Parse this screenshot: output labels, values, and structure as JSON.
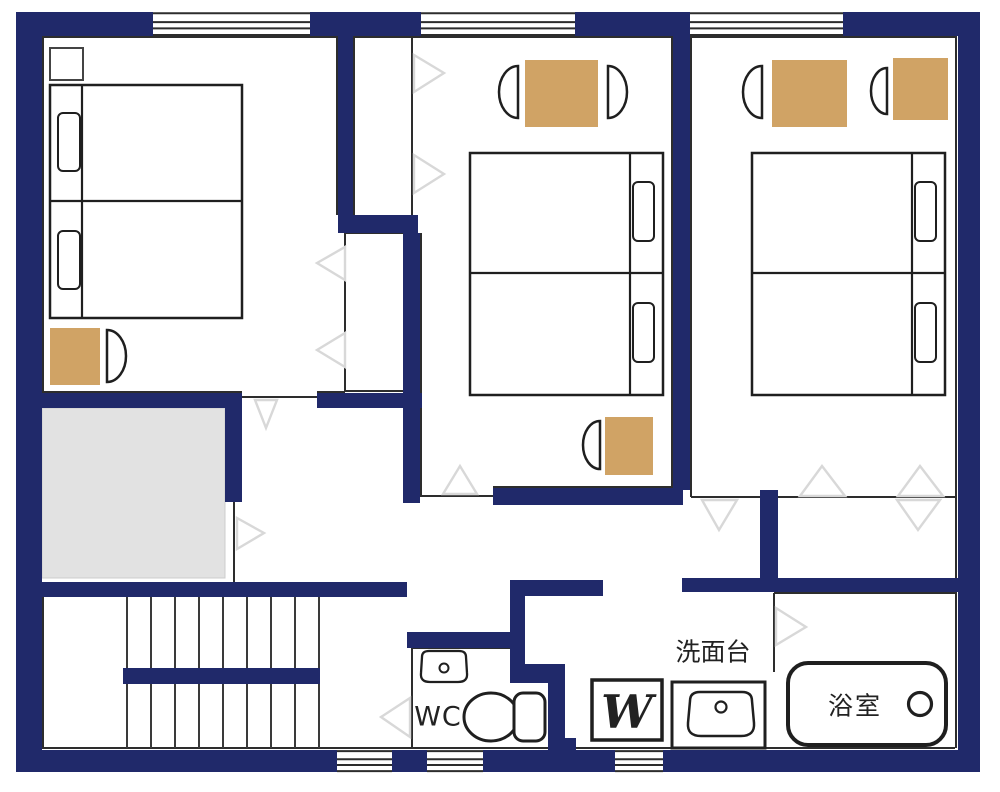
{
  "colors": {
    "wall_navy": "#20296a",
    "mat_tan": "#d0a365",
    "gray_area": "#e2e2e2",
    "gray_area_border": "#cccccc",
    "thin_line": "#2d2d2d",
    "furniture_line": "#1f1f1f",
    "door_marker": "#d8d8d8",
    "floor_white": "#ffffff"
  },
  "labels": {
    "wc": "WC",
    "washstand": "洗面台",
    "bathroom": "浴室",
    "washer": "W"
  },
  "plan": {
    "canvas": [
      1000,
      792
    ],
    "walls": [
      {
        "name": "outer-wall-top",
        "r": [
          16,
          12,
          942,
          24
        ]
      },
      {
        "name": "outer-wall-bottom",
        "r": [
          16,
          750,
          942,
          22
        ]
      },
      {
        "name": "outer-wall-left",
        "r": [
          16,
          12,
          26,
          760
        ]
      },
      {
        "name": "outer-wall-right",
        "r": [
          958,
          12,
          22,
          760
        ]
      },
      {
        "name": "wall-room1-closet-top",
        "r": [
          338,
          36,
          15,
          179
        ]
      },
      {
        "name": "wall-closet-jog",
        "r": [
          338,
          215,
          80,
          18
        ]
      },
      {
        "name": "wall-room2-left",
        "r": [
          403,
          233,
          17,
          270
        ]
      },
      {
        "name": "wall-room1-bottom-right",
        "r": [
          317,
          393,
          105,
          15
        ]
      },
      {
        "name": "wall-room1-bottom-left",
        "r": [
          42,
          393,
          200,
          15
        ]
      },
      {
        "name": "wall-gray-area-right",
        "r": [
          225,
          393,
          17,
          109
        ]
      },
      {
        "name": "wall-above-stairs",
        "r": [
          42,
          582,
          365,
          15
        ]
      },
      {
        "name": "wall-hall-mid",
        "r": [
          510,
          580,
          93,
          16
        ]
      },
      {
        "name": "wall-bath-top",
        "r": [
          682,
          578,
          276,
          14
        ]
      },
      {
        "name": "wall-engawa-divider",
        "r": [
          760,
          490,
          18,
          102
        ]
      },
      {
        "name": "wall-room2-bottom",
        "r": [
          493,
          488,
          190,
          17
        ]
      },
      {
        "name": "wall-room2-room3-divider",
        "r": [
          673,
          36,
          17,
          454
        ]
      },
      {
        "name": "wall-wc-right-upper",
        "r": [
          510,
          596,
          15,
          74
        ]
      },
      {
        "name": "wall-wc-jog",
        "r": [
          510,
          664,
          42,
          19
        ]
      },
      {
        "name": "wall-wc-right-lower",
        "r": [
          548,
          664,
          17,
          86
        ]
      },
      {
        "name": "wall-wc-top",
        "r": [
          407,
          632,
          103,
          16
        ]
      },
      {
        "name": "stair-rail",
        "r": [
          123,
          668,
          197,
          16
        ]
      },
      {
        "name": "wall-wc-foot-block",
        "r": [
          548,
          738,
          28,
          12
        ]
      }
    ],
    "windows": [
      {
        "name": "window-top-1",
        "r": [
          153,
          12,
          157,
          24
        ]
      },
      {
        "name": "window-top-2",
        "r": [
          421,
          12,
          154,
          24
        ]
      },
      {
        "name": "window-top-3",
        "r": [
          690,
          12,
          153,
          24
        ]
      },
      {
        "name": "window-bottom-1",
        "r": [
          337,
          750,
          55,
          22
        ]
      },
      {
        "name": "window-bottom-2",
        "r": [
          427,
          750,
          56,
          22
        ]
      },
      {
        "name": "window-bottom-3",
        "r": [
          615,
          750,
          48,
          22
        ]
      }
    ],
    "lines": [
      [
        42,
        37,
        957,
        37
      ],
      [
        42,
        748,
        955,
        748
      ],
      [
        43,
        37,
        43,
        394
      ],
      [
        43,
        596,
        43,
        748
      ],
      [
        956,
        37,
        956,
        748
      ],
      [
        337,
        37,
        337,
        215
      ],
      [
        354,
        37,
        354,
        215
      ],
      [
        412,
        37,
        412,
        215
      ],
      [
        421,
        233,
        421,
        497
      ],
      [
        345,
        233,
        345,
        391
      ],
      [
        345,
        233,
        403,
        233
      ],
      [
        345,
        391,
        403,
        391
      ],
      [
        42,
        392,
        242,
        392
      ],
      [
        242,
        397,
        317,
        397
      ],
      [
        317,
        392,
        345,
        392
      ],
      [
        672,
        37,
        672,
        488
      ],
      [
        691,
        37,
        691,
        497
      ],
      [
        421,
        496,
        493,
        496
      ],
      [
        493,
        487,
        672,
        487
      ],
      [
        691,
        497,
        955,
        497
      ],
      [
        234,
        502,
        234,
        582
      ],
      [
        774,
        593,
        774,
        672
      ],
      [
        774,
        593,
        955,
        593
      ],
      [
        412,
        647,
        412,
        748
      ],
      [
        412,
        648,
        510,
        648
      ]
    ],
    "gray_area": {
      "name": "stairwell-void",
      "r": [
        42,
        408,
        183,
        170
      ]
    },
    "stairs": {
      "name": "staircase",
      "treads_x": [
        127,
        151,
        175,
        199,
        223,
        247,
        271,
        295,
        319
      ],
      "upper_flight_y": [
        596,
        668
      ],
      "lower_flight_y": [
        684,
        748
      ]
    },
    "mats": [
      {
        "name": "mat-room1",
        "r": [
          50,
          328,
          50,
          57
        ]
      },
      {
        "name": "mat-room2-table",
        "r": [
          525,
          60,
          73,
          67
        ]
      },
      {
        "name": "mat-room2-lower",
        "r": [
          605,
          417,
          48,
          58
        ]
      },
      {
        "name": "mat-room3-table",
        "r": [
          772,
          60,
          75,
          67
        ]
      },
      {
        "name": "mat-room3-side",
        "r": [
          893,
          58,
          55,
          62
        ]
      }
    ],
    "beds": [
      {
        "name": "bed-room1",
        "rect": [
          50,
          85,
          192,
          233
        ],
        "lines": [
          [
            82,
            85,
            82,
            318
          ],
          [
            50,
            201,
            242,
            201
          ]
        ],
        "pillows": [
          [
            58,
            113,
            22,
            58
          ],
          [
            58,
            231,
            22,
            58
          ]
        ]
      },
      {
        "name": "bed-room2",
        "rect": [
          470,
          153,
          193,
          242
        ],
        "lines": [
          [
            630,
            153,
            630,
            395
          ],
          [
            470,
            273,
            663,
            273
          ]
        ],
        "pillows": [
          [
            633,
            182,
            21,
            59
          ],
          [
            633,
            303,
            21,
            59
          ]
        ]
      },
      {
        "name": "bed-room3",
        "rect": [
          752,
          153,
          193,
          242
        ],
        "lines": [
          [
            912,
            153,
            912,
            395
          ],
          [
            752,
            273,
            945,
            273
          ]
        ],
        "pillows": [
          [
            915,
            182,
            21,
            59
          ],
          [
            915,
            303,
            21,
            59
          ]
        ]
      }
    ],
    "nightstand": {
      "name": "nightstand-room1",
      "r": [
        50,
        48,
        33,
        32
      ]
    },
    "chairs": [
      {
        "name": "chair-room1",
        "d": "M107,330 A19,26 0 0 1 107,382 Z"
      },
      {
        "name": "chair-room2-left",
        "d": "M518,66 A19,26 0 0 0 518,118 Z"
      },
      {
        "name": "chair-room2-right",
        "d": "M608,66 A19,26 0 0 1 608,118 Z"
      },
      {
        "name": "chair-room2-lower",
        "d": "M600,421 A17,24 0 0 0 600,469 Z"
      },
      {
        "name": "chair-room3-left",
        "d": "M762,66 A19,26 0 0 0 762,118 Z"
      },
      {
        "name": "chair-room3-side",
        "d": "M887,68 A16,23 0 0 0 887,114 Z"
      }
    ],
    "fixtures": {
      "toilet_bowl": {
        "name": "toilet-bowl-icon",
        "cx": 491,
        "cy": 717,
        "rx": 27,
        "ry": 24
      },
      "toilet_tank": {
        "name": "toilet-tank-icon",
        "r": [
          514,
          693,
          31,
          48
        ],
        "rx": 9
      },
      "wc_sink": {
        "name": "small-sink-icon",
        "d": "M429,651 h30 q7,0 7,6 l1,16 q1,9 -9,9 h-28 q-10,0 -9,-9 l1,-16 q0,-6 7,-6 z",
        "circle": [
          444,
          668,
          4.5
        ]
      },
      "washer_box": {
        "name": "washing-machine-box",
        "r": [
          592,
          680,
          70,
          60
        ]
      },
      "wash_unit_box": {
        "name": "washstand-box",
        "r": [
          672,
          682,
          93,
          66
        ]
      },
      "wash_basin": {
        "name": "washbasin-icon",
        "d": "M700,692 h42 q10,0 10,9 l2,22 q1,13 -13,13 h-40 q-14,0 -13,-13 l2,-22 q0,-9 10,-9 z",
        "circle": [
          721,
          707,
          5.5
        ]
      },
      "bathtub": {
        "name": "bathtub-icon",
        "r": [
          788,
          663,
          158,
          82
        ],
        "rx": 20,
        "drain": [
          920,
          704,
          11.5
        ]
      }
    },
    "triangles": [
      {
        "name": "door-marker-room1-entry",
        "pts": "255,400 277,400 266,428"
      },
      {
        "name": "door-marker-room2-entry",
        "pts": "443,494 477,494 460,466"
      },
      {
        "name": "door-marker-hall",
        "pts": "237,518 237,549 264,533"
      },
      {
        "name": "door-marker-closet1-a",
        "pts": "345,247 345,280 317,263"
      },
      {
        "name": "door-marker-closet1-b",
        "pts": "345,333 345,367 317,350"
      },
      {
        "name": "door-marker-closet2-a",
        "pts": "414,55 414,92 444,73"
      },
      {
        "name": "door-marker-closet2-b",
        "pts": "414,155 414,193 444,174"
      },
      {
        "name": "door-marker-engawa-a",
        "pts": "800,496 845,496 822,466"
      },
      {
        "name": "door-marker-engawa-b",
        "pts": "898,496 943,496 920,466"
      },
      {
        "name": "door-marker-engawa-c",
        "pts": "702,500 737,500 719,530"
      },
      {
        "name": "door-marker-engawa-d",
        "pts": "897,500 940,500 918,530"
      },
      {
        "name": "door-marker-bathroom",
        "pts": "776,608 776,645 806,627"
      },
      {
        "name": "door-marker-wc",
        "pts": "410,698 410,737 381,717"
      }
    ],
    "label_items": [
      {
        "name": "wc-label",
        "key": "wc",
        "x": 438,
        "y": 717,
        "size": 27,
        "style": "sans",
        "spacing": 1
      },
      {
        "name": "washstand-label",
        "key": "washstand",
        "x": 713,
        "y": 652,
        "size": 25,
        "style": "sans",
        "spacing": 0
      },
      {
        "name": "bathroom-label",
        "key": "bathroom",
        "x": 855,
        "y": 706,
        "size": 25,
        "style": "sans",
        "spacing": 2
      },
      {
        "name": "washer-label",
        "key": "washer",
        "x": 627,
        "y": 712,
        "size": 46,
        "style": "serif-italic",
        "spacing": 0
      }
    ]
  }
}
